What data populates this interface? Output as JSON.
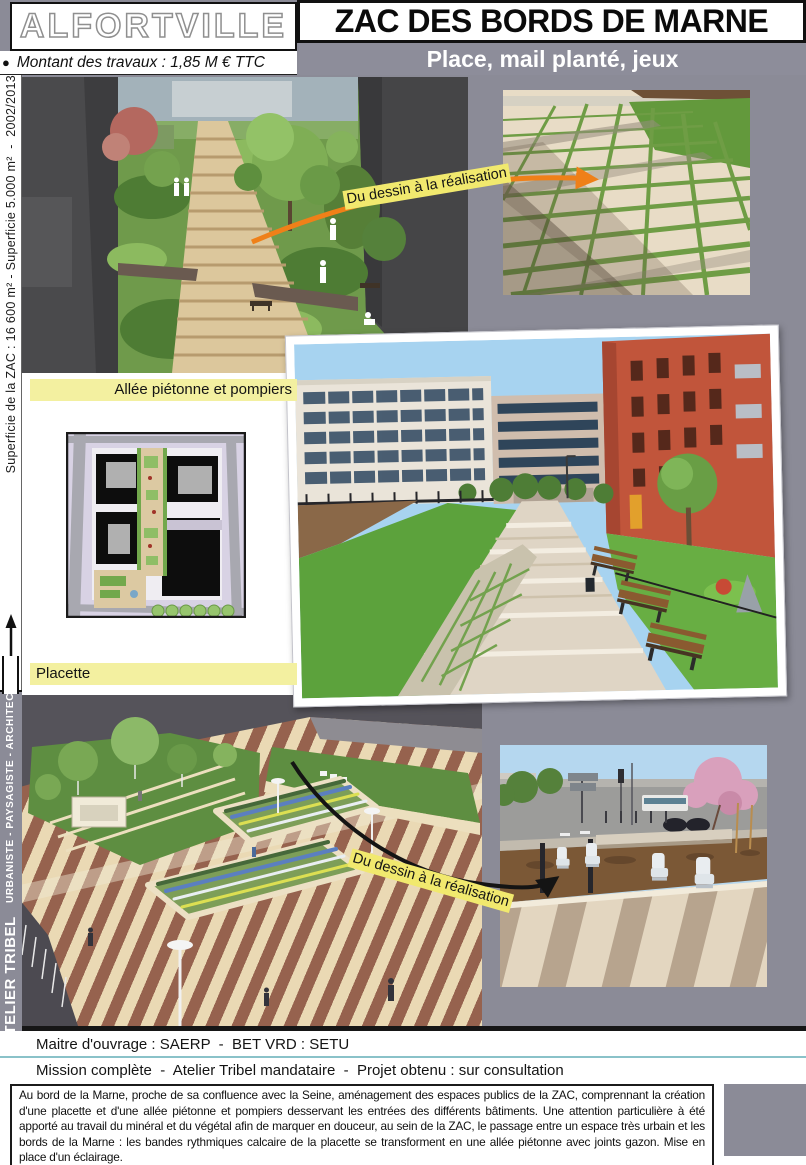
{
  "header": {
    "city": "ALFORTVILLE",
    "title": "ZAC DES BORDS DE MARNE",
    "subtitle": "Place, mail planté, jeux",
    "bullet": "●",
    "cost": "Montant des travaux : 1,85 M € TTC"
  },
  "sidebar": {
    "project_info": "Superficie de la ZAC : 16 600 m² - Superficie 5.000 m²  -  2002/2013",
    "firm": "ATELIER TRIBEL",
    "firm_gap": "   ",
    "firm_roles": "URBANISTE - PAYSAGISTE - ARCHITECTE"
  },
  "labels": {
    "allee": "Allée piétonne et pompiers",
    "placette": "Placette",
    "annotation_top": "Du dessin à la réalisation",
    "annotation_bottom": "Du dessin à la réalisation"
  },
  "footer": {
    "line1": "Maitre d'ouvrage : SAERP  -  BET VRD : SETU",
    "line2": "Mission complète  -  Atelier Tribel mandataire  -  Projet obtenu : sur consultation",
    "description": "Au bord de la Marne, proche de sa confluence avec la Seine, aménagement des espaces publics de la ZAC, comprennant la création d'une placette et d'une allée piétonne et pompiers desservant les entrées des différents bâtiments. Une attention particulière à été apporté au travail du minéral et du végétal afin de marquer en douceur, au sein de la ZAC, le passage entre un espace très urbain et les bords de la Marne : les bandes rythmiques calcaire de la placette se transforment en une allée piétonne avec joints gazon. Mise en place d'un éclairage."
  },
  "colors": {
    "page_gray": "#8b8b97",
    "highlight_yellow": "#f3f0a0",
    "annotation_yellow": "#f1e96e",
    "arrow_orange": "#ef8018",
    "rule_teal": "#8ac2c9"
  }
}
